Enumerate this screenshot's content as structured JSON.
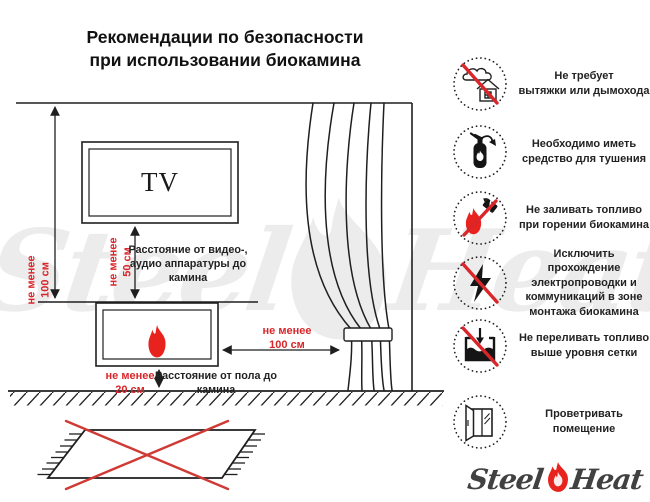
{
  "title": "Рекомендации по безопасности\nпри использовании биокамина",
  "diagram": {
    "tv_label": "TV",
    "dims": {
      "wall": "не менее\n100 см",
      "tv": "не менее\n50 см",
      "floor": "не менее\n20 см",
      "curtain": "не менее\n100 см"
    },
    "notes": {
      "tv": "Расстояние от видео-,\nаудио аппаратуры до\nкамина",
      "floor": "Расстояние от пола до\nкамина"
    }
  },
  "rules": [
    {
      "icon": "no-chimney-icon",
      "prohibited": true,
      "text": "Не требует\nвытяжки или дымохода"
    },
    {
      "icon": "extinguisher-icon",
      "prohibited": false,
      "text": "Необходимо иметь\nсредство для тушения"
    },
    {
      "icon": "no-refuel-icon",
      "prohibited": true,
      "text": "Не заливать топливо\nпри горении биокамина"
    },
    {
      "icon": "no-wiring-icon",
      "prohibited": true,
      "text": "Исключить прохождение\nэлектропроводки и\nкоммуникаций в зоне\nмонтажа биокамина"
    },
    {
      "icon": "no-overfill-icon",
      "prohibited": true,
      "text": "Не переливать топливо\nвыше уровня сетки"
    },
    {
      "icon": "ventilate-window-icon",
      "prohibited": false,
      "text": "Проветривать\nпомещение"
    }
  ],
  "logo": {
    "steel": "Steel",
    "heat": "Heat"
  },
  "watermark": {
    "steel": "Steel",
    "heat": "Heat"
  },
  "colors": {
    "red": "#d9262b",
    "flame_red": "#e8231e",
    "line": "#1f1f1f",
    "watermark_gray": "#ececec"
  }
}
